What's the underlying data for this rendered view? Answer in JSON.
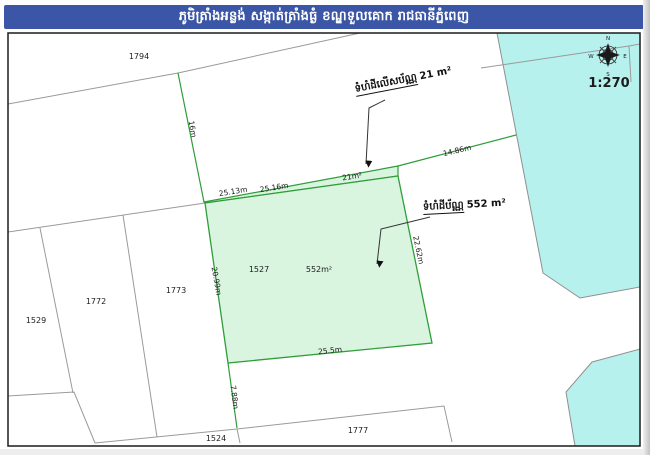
{
  "header": {
    "title": "ភូមិត្រាំងអន្លង់ សង្កាត់ត្រាំងធ្ងំ ខណ្ឌទួលគោក រាជធានីភ្នំពេញ"
  },
  "map": {
    "scale_label": "1:270",
    "compass": {
      "n": "N",
      "e": "E",
      "s": "S",
      "w": "W"
    },
    "parcels": {
      "p1794": "1794",
      "p1529": "1529",
      "p1772": "1772",
      "p1773": "1773",
      "p1527": "1527",
      "p1527_area": "552m²",
      "p1524": "1524",
      "p1777": "1777",
      "strip_area": "21m²"
    },
    "measurements": {
      "m16": "16m",
      "m2513": "25.13m",
      "m2516": "25.16m",
      "m1486": "14.86m",
      "m2099": "20.99m",
      "m2262": "22.62m",
      "m255": "25.5m",
      "m788": "7.88m"
    },
    "annotations": {
      "excess": {
        "label": "ទំហំដីលើសប័ណ្ណ",
        "value": "21 m²"
      },
      "title_area": {
        "label": "ទំហំដីប័ណ្ណ",
        "value": "552 m²"
      }
    },
    "colors": {
      "header_blue": "#3b56a6",
      "frame": "#1b1b1b",
      "boundary_gray": "#9a9a9a",
      "green_line": "#2f9e39",
      "green_fill": "#d9f4df",
      "cyan_fill": "#b6f1ee",
      "cyan_stroke": "#8f8f8f"
    }
  }
}
